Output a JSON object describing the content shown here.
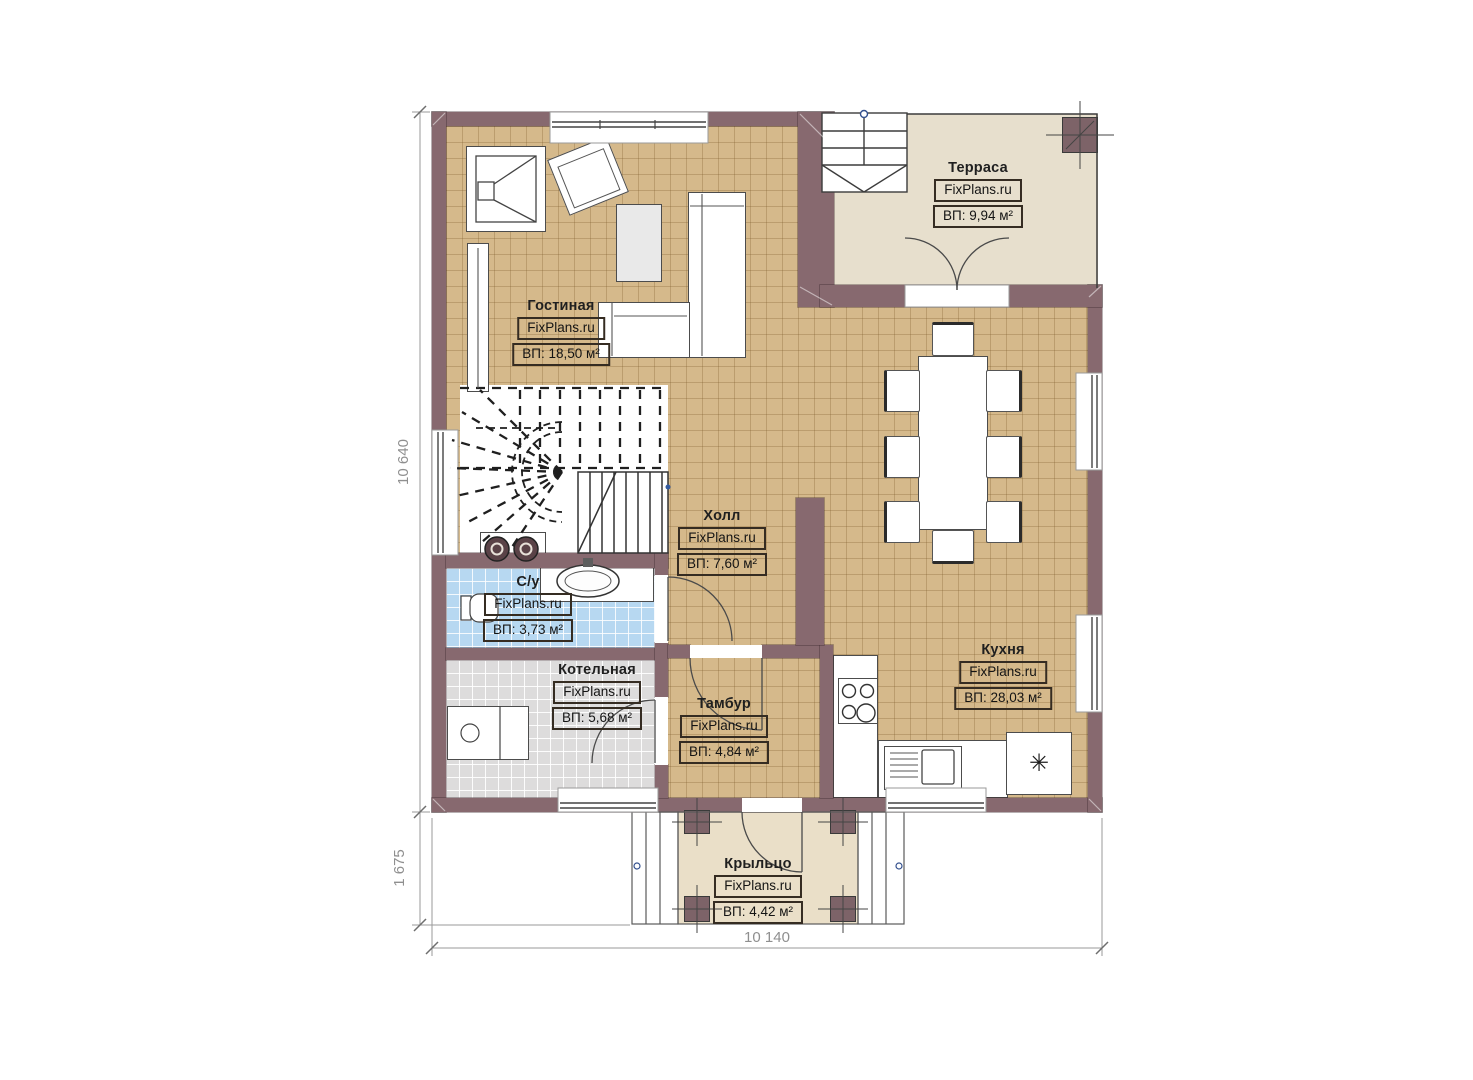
{
  "plan": {
    "watermark": "FixPlans.ru",
    "rooms": [
      {
        "key": "living",
        "name": "Гостиная",
        "area_label": "ВП: 18,50 м²"
      },
      {
        "key": "terrace",
        "name": "Терраса",
        "area_label": "ВП: 9,94 м²"
      },
      {
        "key": "hall",
        "name": "Холл",
        "area_label": "ВП: 7,60 м²"
      },
      {
        "key": "bathroom",
        "name": "С/у",
        "area_label": "ВП: 3,73 м²"
      },
      {
        "key": "boiler",
        "name": "Котельная",
        "area_label": "ВП: 5,68 м²"
      },
      {
        "key": "vestibule",
        "name": "Тамбур",
        "area_label": "ВП: 4,84 м²"
      },
      {
        "key": "kitchen",
        "name": "Кухня",
        "area_label": "ВП: 28,03 м²"
      },
      {
        "key": "porch",
        "name": "Крыльцо",
        "area_label": "ВП: 4,42 м²"
      }
    ],
    "dimensions": {
      "left_total": "10 640",
      "left_porch": "1 675",
      "bottom_total": "10 140"
    },
    "symbols": {
      "fridge": "✳"
    },
    "colors": {
      "wall": "#87696f",
      "floor_main": "#d5b98b",
      "floor_terrace": "#e7dfcd",
      "floor_bath": "#b7d8f1",
      "floor_boiler": "#dddcdc",
      "dimension_text": "#8f8f8f"
    }
  }
}
